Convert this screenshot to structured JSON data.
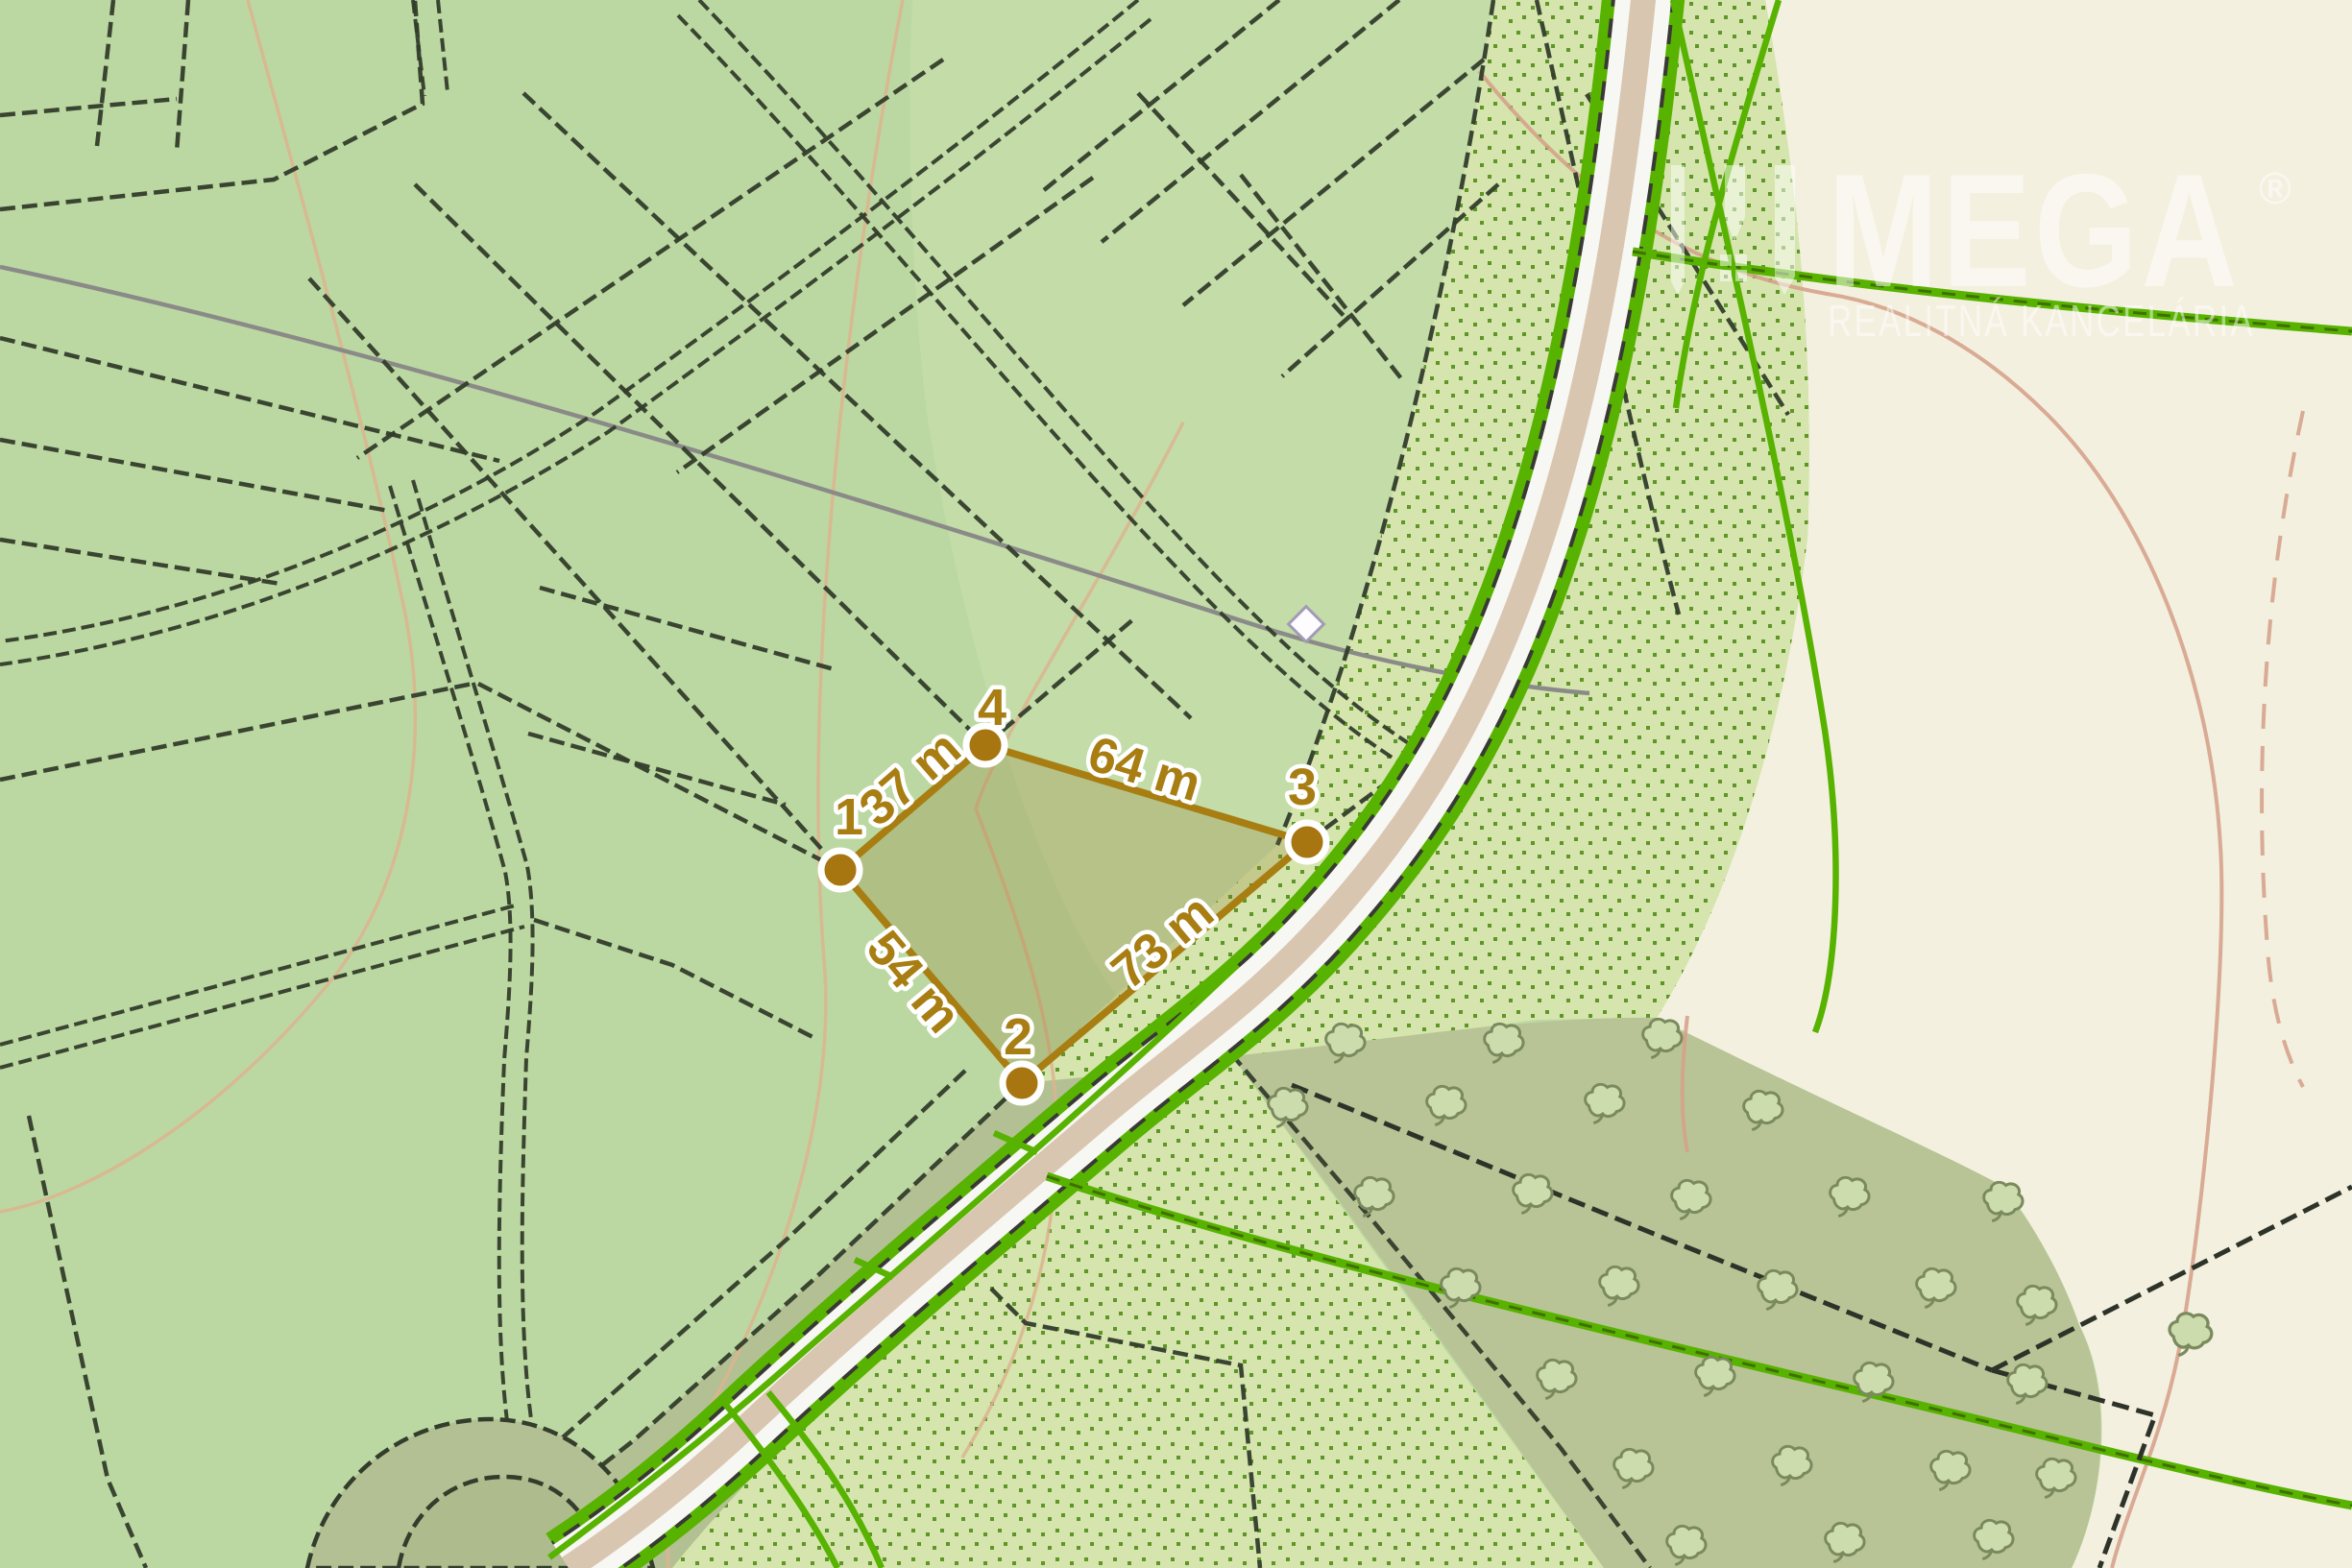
{
  "watermark": {
    "brand": "MEGA",
    "registered": "®",
    "subtitle": "REALITNÁ KANCELÁRIA"
  },
  "measurement": {
    "unit": "m",
    "vertices": [
      {
        "id": "1"
      },
      {
        "id": "2"
      },
      {
        "id": "3"
      },
      {
        "id": "4"
      }
    ],
    "sides": [
      {
        "between": "1-4",
        "label": "37 m",
        "length_m": 37
      },
      {
        "between": "4-3",
        "label": "64 m",
        "length_m": 64
      },
      {
        "between": "1-2",
        "label": "54 m",
        "length_m": 54
      },
      {
        "between": "2-3",
        "label": "73 m",
        "length_m": 73
      }
    ]
  },
  "colors": {
    "measure_accent": "#a87e12",
    "vertex_fill": "#a87610",
    "base_green": "#bcd8a2",
    "dotted_bg": "#d5e5ad",
    "dot_green": "#5f9628",
    "orchard_olive": "#b8c496",
    "cream_field": "#f3f0df",
    "road_fill": "#d9c6b0",
    "road_shoulder": "#f7f7f3",
    "track_green": "#58b300",
    "contour_tan": "#dcb48f",
    "watermark_white": "#ffffff"
  }
}
